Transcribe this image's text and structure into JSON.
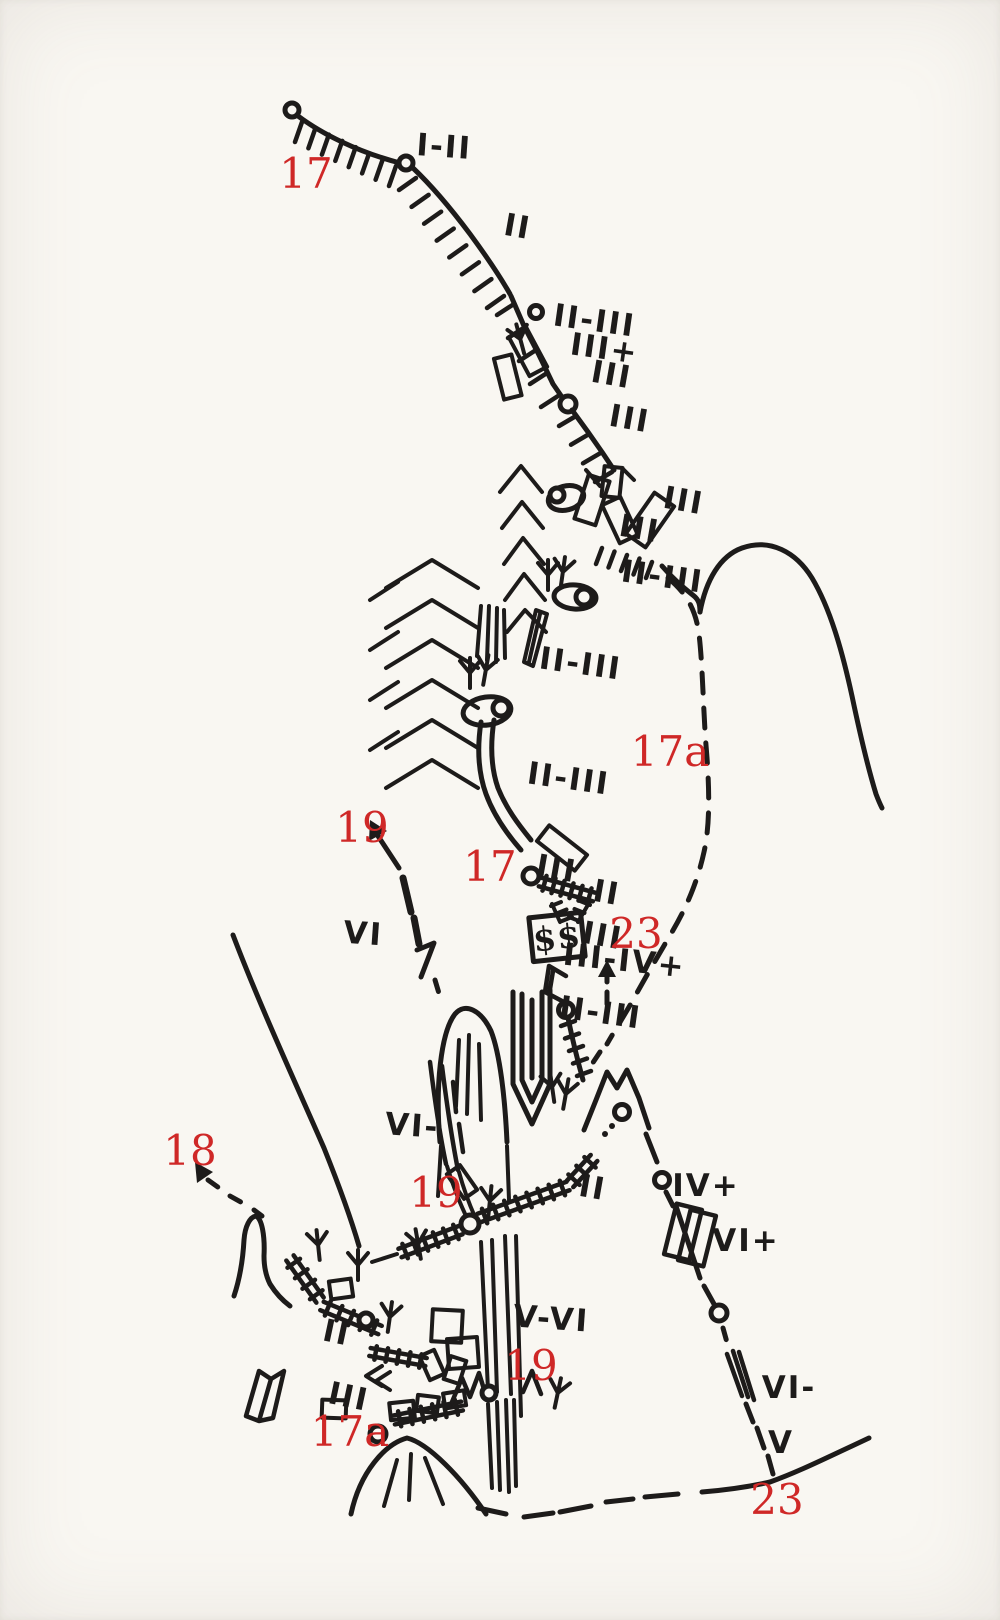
{
  "colors": {
    "ink": "#1d1b1a",
    "red": "#cf2827",
    "paper": "#f9f7f2"
  },
  "bivouac": {
    "text": "$$"
  },
  "routes": [
    {
      "id": "17-top",
      "text": "17"
    },
    {
      "id": "17a-upper",
      "text": "17a"
    },
    {
      "id": "19-upper",
      "text": "19"
    },
    {
      "id": "17-mid",
      "text": "17"
    },
    {
      "id": "23-mid",
      "text": "23"
    },
    {
      "id": "18-left",
      "text": "18"
    },
    {
      "id": "19-mid",
      "text": "19"
    },
    {
      "id": "19-lower",
      "text": "19"
    },
    {
      "id": "17a-lower",
      "text": "17a"
    },
    {
      "id": "23-lower",
      "text": "23"
    }
  ],
  "grades": [
    {
      "text": "I-II"
    },
    {
      "text": "II"
    },
    {
      "text": "II-III"
    },
    {
      "text": "III+"
    },
    {
      "text": "III"
    },
    {
      "text": "III"
    },
    {
      "text": "III"
    },
    {
      "text": "III"
    },
    {
      "text": "II-III"
    },
    {
      "text": "II-III"
    },
    {
      "text": "II-III"
    },
    {
      "text": "III"
    },
    {
      "text": "II"
    },
    {
      "text": "III"
    },
    {
      "text": "III-IV+"
    },
    {
      "text": "II-III"
    },
    {
      "text": "VI"
    },
    {
      "text": "VI-"
    },
    {
      "text": "II"
    },
    {
      "text": "IV+"
    },
    {
      "text": "VI+"
    },
    {
      "text": "II"
    },
    {
      "text": "III"
    },
    {
      "text": "V-VI"
    },
    {
      "text": "VI-"
    },
    {
      "text": "V"
    }
  ]
}
